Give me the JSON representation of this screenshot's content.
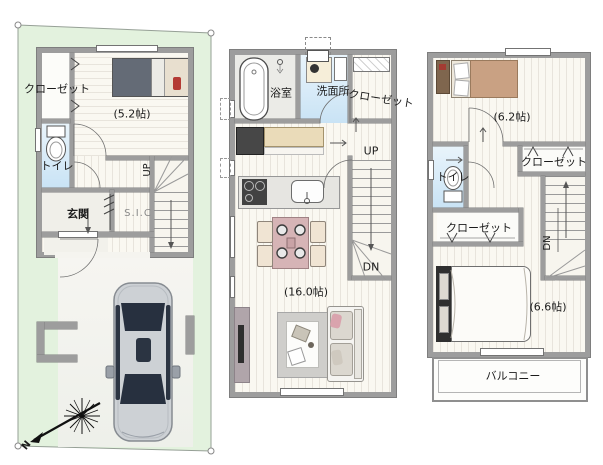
{
  "colors": {
    "plot_green": "#e3f2de",
    "wall_gray": "#9d9d9d",
    "wet_blue": "#cfe7f6"
  },
  "floor1": {
    "closet_label": "クローゼット",
    "bedroom_size": "(5.2帖)",
    "toilet_label": "トイレ",
    "entrance_label": "玄関",
    "shoe_closet_label": "S.I.C",
    "stairs_up": "UP",
    "compass_north": "N"
  },
  "floor2": {
    "bathroom_label": "浴室",
    "washroom_label": "洗面所",
    "closet_label": "クローゼット",
    "stairs_up": "UP",
    "stairs_down": "DN",
    "living_size": "(16.0帖)"
  },
  "floor3": {
    "bedroom1_size": "(6.2帖)",
    "toilet_label": "トイレ",
    "closet1_label": "クローゼット",
    "closet2_label": "クローゼット",
    "stairs_down": "DN",
    "bedroom2_size": "(6.6帖)",
    "balcony_label": "バルコニー"
  }
}
